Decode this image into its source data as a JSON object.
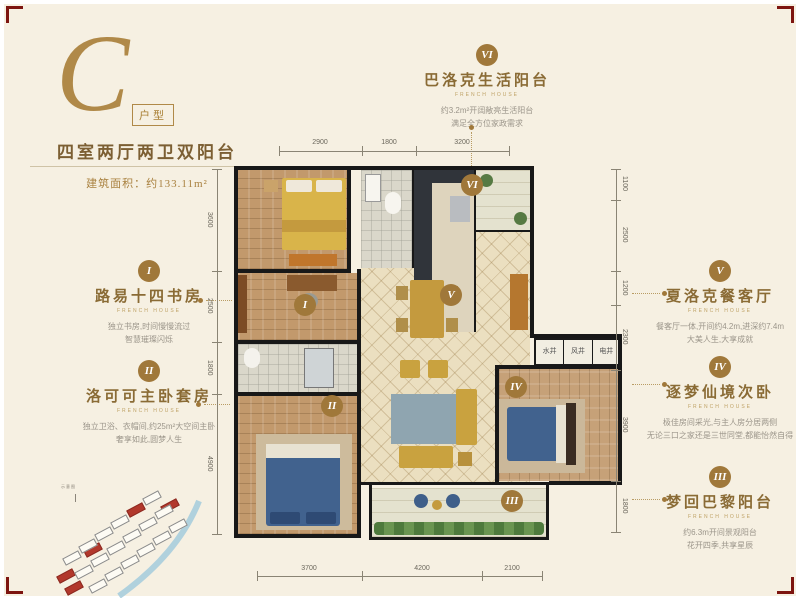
{
  "page": {
    "bg": "#f6f0e2",
    "accent": "#a9813f",
    "corner_color": "#7d1510"
  },
  "header": {
    "letter": "C",
    "letter_tag": "户型",
    "title": "四室两厅两卫双阳台",
    "area_label": "建筑面积：约133.11m²"
  },
  "annotations": [
    {
      "numeral": "I",
      "title": "路易十四书房",
      "subtitle": "FRENCH HOUSE",
      "desc1": "独立书房,时间慢慢流过",
      "desc2": "智慧璀璨闪烁"
    },
    {
      "numeral": "II",
      "title": "洛可可主卧套房",
      "subtitle": "FRENCH HOUSE",
      "desc1": "独立卫浴、衣帽间,约25m²大空间主卧",
      "desc2": "奢享如此,圆梦人生"
    },
    {
      "numeral": "III",
      "title": "梦回巴黎阳台",
      "subtitle": "FRENCH HOUSE",
      "desc1": "约6.3m开间景观阳台",
      "desc2": "花开四季,共享星辰"
    },
    {
      "numeral": "IV",
      "title": "逐梦仙境次卧",
      "subtitle": "FRENCH HOUSE",
      "desc1": "极佳房间采光,与主人房分居两侧",
      "desc2": "无论三口之家还是三世同堂,都能怡然自得"
    },
    {
      "numeral": "V",
      "title": "夏洛克餐客厅",
      "subtitle": "FRENCH HOUSE",
      "desc1": "餐客厅一体,开间约4.2m,进深约7.4m",
      "desc2": "大美人生,大享成就"
    },
    {
      "numeral": "VI",
      "title": "巴洛克生活阳台",
      "subtitle": "FRENCH HOUSE",
      "desc1": "约3.2m²开阔敞亮生活阳台",
      "desc2": "满足全方位家政需求"
    }
  ],
  "floorplan": {
    "room_markers": [
      "I",
      "II",
      "III",
      "IV",
      "V",
      "VI"
    ],
    "shafts": [
      "水井",
      "风井",
      "电井"
    ],
    "dimensions": {
      "top": [
        "2900",
        "1800",
        "3200"
      ],
      "bottom": [
        "3700",
        "4200",
        "2100"
      ],
      "left": [
        "3600",
        "2500",
        "1800",
        "4900"
      ],
      "right": [
        "1100",
        "2500",
        "1200",
        "2300",
        "3900",
        "1800"
      ]
    }
  },
  "site_map": {
    "caption": "示意图",
    "buildings": [
      {
        "x": 8,
        "y": 96,
        "red": true
      },
      {
        "x": 16,
        "y": 108,
        "red": true
      },
      {
        "x": 35,
        "y": 70,
        "red": true
      },
      {
        "x": 78,
        "y": 30,
        "red": true
      },
      {
        "x": 112,
        "y": 26,
        "red": true
      },
      {
        "x": 14,
        "y": 78
      },
      {
        "x": 30,
        "y": 66
      },
      {
        "x": 46,
        "y": 54
      },
      {
        "x": 62,
        "y": 42
      },
      {
        "x": 94,
        "y": 18
      },
      {
        "x": 26,
        "y": 92
      },
      {
        "x": 42,
        "y": 80
      },
      {
        "x": 58,
        "y": 68
      },
      {
        "x": 74,
        "y": 56
      },
      {
        "x": 90,
        "y": 44
      },
      {
        "x": 106,
        "y": 32
      },
      {
        "x": 40,
        "y": 106
      },
      {
        "x": 56,
        "y": 94
      },
      {
        "x": 72,
        "y": 82
      },
      {
        "x": 88,
        "y": 70
      },
      {
        "x": 104,
        "y": 58
      },
      {
        "x": 120,
        "y": 46
      }
    ]
  }
}
